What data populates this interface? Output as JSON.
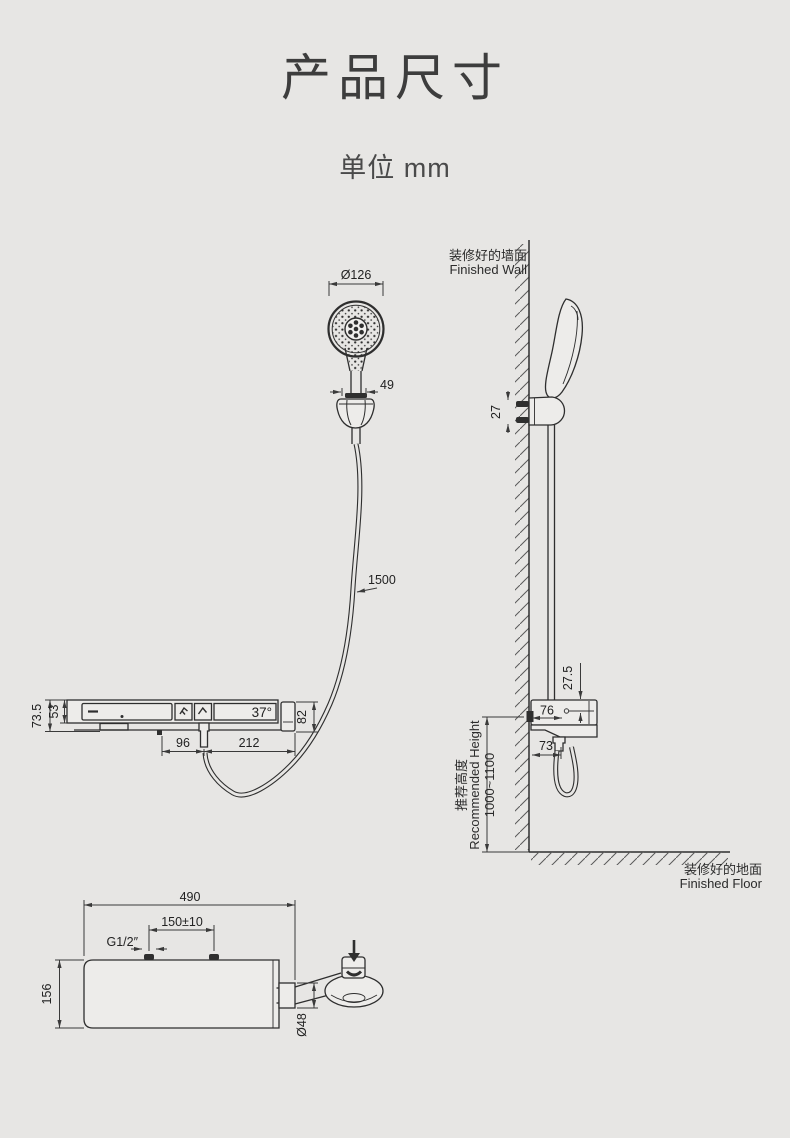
{
  "page": {
    "title": "产品尺寸",
    "unit_label": "单位 mm",
    "background_color": "#e7e6e4",
    "line_color": "#2e2e2e"
  },
  "views": {
    "hand_shower_front": {
      "head_diameter": "Ø126",
      "holder_width": "49",
      "hose_length": "1500"
    },
    "panel_front": {
      "total_height": "73.5",
      "body_height": "53",
      "temp_display": "37°",
      "end_cap_height": "82",
      "hose_offset": "96",
      "hose_to_end": "212",
      "icons": [
        "power-dash-icon",
        "spray-mode-icon",
        "hand-shower-icon"
      ]
    },
    "side_view": {
      "wall_label_zh": "装修好的墙面",
      "wall_label_en": "Finished Wall",
      "floor_label_zh": "装修好的地面",
      "floor_label_en": "Finished Floor",
      "bracket_bolt_spacing": "27",
      "panel_top_offset": "27.5",
      "panel_depth": "76",
      "hose_clearance": "73",
      "height_label_zh": "推荐高度",
      "height_label_en": "Recommended Height",
      "height_range": "1000~1100"
    },
    "panel_top_view": {
      "total_width": "490",
      "inlet_spacing": "150±10",
      "thread_size": "G1/2″",
      "total_depth": "156",
      "outlet_diameter": "Ø48"
    }
  }
}
